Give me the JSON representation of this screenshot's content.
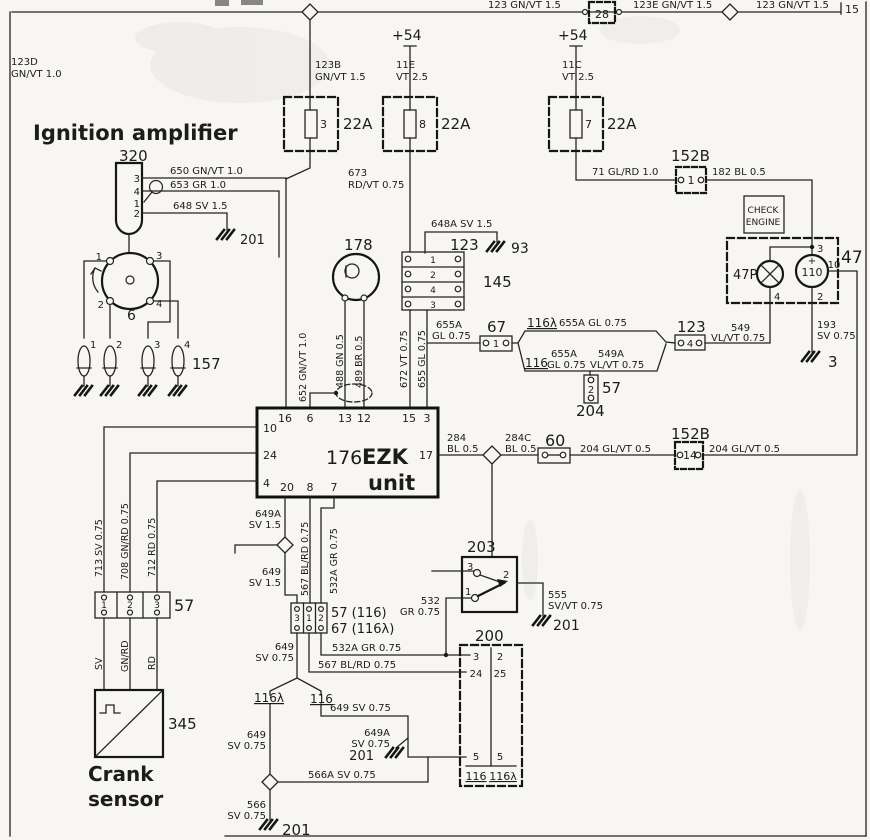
{
  "colors": {
    "ink": "#1c1c1c",
    "annotation_blue": "#5d80b4",
    "paper": "#f7f6f2"
  },
  "labels": [
    {
      "t": "123 GN/VT 1.5",
      "x": 488,
      "y": 8,
      "s": 10,
      "n": "wire-123-gnvt-a"
    },
    {
      "t": "28",
      "x": 602,
      "y": 18,
      "s": 11,
      "a": "middle",
      "n": "connector-28-number"
    },
    {
      "t": "123E GN/VT 1.5",
      "x": 633,
      "y": 8,
      "s": 10,
      "n": "wire-123e-gnvt"
    },
    {
      "t": "123 GN/VT 1.5",
      "x": 756,
      "y": 8,
      "s": 10,
      "n": "wire-123-gnvt-b"
    },
    {
      "t": "15",
      "x": 845,
      "y": 13,
      "s": 11,
      "n": "terminal-15"
    },
    {
      "t": "123D",
      "x": 11,
      "y": 65,
      "s": 10,
      "n": "wire-123d"
    },
    {
      "t": "GN/VT 1.0",
      "x": 11,
      "y": 77,
      "s": 10
    },
    {
      "t": "+54",
      "x": 392,
      "y": 40,
      "s": 14,
      "n": "terminal-54-a"
    },
    {
      "t": "+54",
      "x": 558,
      "y": 40,
      "s": 14,
      "n": "terminal-54-b"
    },
    {
      "t": "123B",
      "x": 315,
      "y": 68,
      "s": 10,
      "n": "wire-123b"
    },
    {
      "t": "GN/VT 1.5",
      "x": 315,
      "y": 80,
      "s": 10
    },
    {
      "t": "11E",
      "x": 396,
      "y": 68,
      "s": 10,
      "n": "wire-11e"
    },
    {
      "t": "VT 2.5",
      "x": 396,
      "y": 80,
      "s": 10
    },
    {
      "t": "11C",
      "x": 562,
      "y": 68,
      "s": 10,
      "n": "wire-11c"
    },
    {
      "t": "VT 2.5",
      "x": 562,
      "y": 80,
      "s": 10
    },
    {
      "t": "3",
      "x": 320,
      "y": 128,
      "s": 11,
      "n": "fuse-3-number"
    },
    {
      "t": "22A",
      "x": 343,
      "y": 129,
      "s": 15,
      "n": "fuse-3-rating"
    },
    {
      "t": "8",
      "x": 419,
      "y": 128,
      "s": 11,
      "n": "fuse-8-number"
    },
    {
      "t": "22A",
      "x": 441,
      "y": 129,
      "s": 15,
      "n": "fuse-8-rating"
    },
    {
      "t": "7",
      "x": 585,
      "y": 128,
      "s": 11,
      "n": "fuse-7-number"
    },
    {
      "t": "22A",
      "x": 607,
      "y": 129,
      "s": 15,
      "n": "fuse-7-rating"
    },
    {
      "t": "Ignition amplifier",
      "x": 33,
      "y": 140,
      "s": 21,
      "w": 1,
      "c": "b",
      "n": "annotation-ignition-amplifier"
    },
    {
      "t": "320",
      "x": 119,
      "y": 161,
      "s": 15,
      "n": "component-320"
    },
    {
      "t": "650 GN/VT 1.0",
      "x": 170,
      "y": 174,
      "s": 10
    },
    {
      "t": "653 GR 1.0",
      "x": 170,
      "y": 188,
      "s": 10
    },
    {
      "t": "648 SV 1.5",
      "x": 173,
      "y": 209,
      "s": 10
    },
    {
      "t": "201",
      "x": 240,
      "y": 244,
      "s": 13,
      "n": "ground-201-a"
    },
    {
      "t": "3",
      "x": 140,
      "y": 182,
      "s": 10,
      "a": "end"
    },
    {
      "t": "4",
      "x": 140,
      "y": 195,
      "s": 10,
      "a": "end"
    },
    {
      "t": "1",
      "x": 140,
      "y": 207,
      "s": 10,
      "a": "end"
    },
    {
      "t": "2",
      "x": 140,
      "y": 217,
      "s": 10,
      "a": "end"
    },
    {
      "t": "673",
      "x": 348,
      "y": 176,
      "s": 10
    },
    {
      "t": "RD/VT 0.75",
      "x": 348,
      "y": 188,
      "s": 10
    },
    {
      "t": "648A SV 1.5",
      "x": 431,
      "y": 227,
      "s": 10
    },
    {
      "t": "123",
      "x": 450,
      "y": 250,
      "s": 15,
      "n": "connector-123-a"
    },
    {
      "t": "93",
      "x": 511,
      "y": 253,
      "s": 14,
      "n": "ground-93"
    },
    {
      "t": "145",
      "x": 483,
      "y": 287,
      "s": 15,
      "n": "connector-145"
    },
    {
      "t": "1",
      "x": 433,
      "y": 263,
      "s": 9,
      "a": "middle"
    },
    {
      "t": "2",
      "x": 433,
      "y": 278,
      "s": 9,
      "a": "middle"
    },
    {
      "t": "4",
      "x": 433,
      "y": 293,
      "s": 9,
      "a": "middle"
    },
    {
      "t": "3",
      "x": 433,
      "y": 308,
      "s": 9,
      "a": "middle"
    },
    {
      "t": "178",
      "x": 344,
      "y": 250,
      "s": 15,
      "n": "component-178"
    },
    {
      "t": "152B",
      "x": 671,
      "y": 161,
      "s": 15,
      "n": "connector-152b-1"
    },
    {
      "t": "1",
      "x": 691,
      "y": 184,
      "s": 11,
      "a": "middle"
    },
    {
      "t": "71 GL/RD 1.0",
      "x": 592,
      "y": 175,
      "s": 10
    },
    {
      "t": "182 BL 0.5",
      "x": 712,
      "y": 175,
      "s": 10
    },
    {
      "t": "CHECK",
      "x": 763,
      "y": 213,
      "s": 9,
      "a": "middle",
      "n": "check-engine-text"
    },
    {
      "t": "ENGINE",
      "x": 763,
      "y": 225,
      "s": 9,
      "a": "middle"
    },
    {
      "t": "47P",
      "x": 733,
      "y": 279,
      "s": 13,
      "n": "lamp-47p"
    },
    {
      "t": "47",
      "x": 841,
      "y": 263,
      "s": 17,
      "n": "component-47"
    },
    {
      "t": "110",
      "x": 812,
      "y": 276,
      "s": 11,
      "a": "middle",
      "n": "gauge-110"
    },
    {
      "t": "+",
      "x": 812,
      "y": 264,
      "s": 10,
      "a": "middle"
    },
    {
      "t": "−",
      "x": 812,
      "y": 290,
      "s": 10,
      "a": "middle"
    },
    {
      "t": "3",
      "x": 817,
      "y": 252,
      "s": 10
    },
    {
      "t": "10",
      "x": 834,
      "y": 268,
      "s": 10,
      "a": "middle"
    },
    {
      "t": "2",
      "x": 817,
      "y": 300,
      "s": 10
    },
    {
      "t": "4",
      "x": 774,
      "y": 300,
      "s": 10
    },
    {
      "t": "193",
      "x": 817,
      "y": 328,
      "s": 10
    },
    {
      "t": "SV 0.75",
      "x": 817,
      "y": 339,
      "s": 10
    },
    {
      "t": "3",
      "x": 828,
      "y": 367,
      "s": 15,
      "n": "ground-3"
    },
    {
      "t": "549",
      "x": 731,
      "y": 331,
      "s": 10
    },
    {
      "t": "VL/VT 0.75",
      "x": 711,
      "y": 341,
      "s": 10
    },
    {
      "t": "123",
      "x": 677,
      "y": 332,
      "s": 15,
      "n": "connector-123-b"
    },
    {
      "t": "4",
      "x": 690,
      "y": 347,
      "s": 10,
      "a": "middle"
    },
    {
      "t": "67",
      "x": 487,
      "y": 332,
      "s": 15,
      "n": "connector-67"
    },
    {
      "t": "1",
      "x": 496,
      "y": 347,
      "s": 10,
      "a": "middle"
    },
    {
      "t": "655A",
      "x": 436,
      "y": 328,
      "s": 10
    },
    {
      "t": "GL 0.75",
      "x": 432,
      "y": 339,
      "s": 10
    },
    {
      "t": "116λ",
      "x": 527,
      "y": 327,
      "s": 12,
      "u": 1,
      "n": "harness-116-lambda"
    },
    {
      "t": "655A GL 0.75",
      "x": 559,
      "y": 326,
      "s": 10
    },
    {
      "t": "116",
      "x": 525,
      "y": 367,
      "s": 12,
      "u": 1,
      "n": "harness-116"
    },
    {
      "t": "655A",
      "x": 551,
      "y": 357,
      "s": 10
    },
    {
      "t": "GL 0.75",
      "x": 547,
      "y": 368,
      "s": 10
    },
    {
      "t": "549A",
      "x": 598,
      "y": 357,
      "s": 10
    },
    {
      "t": "VL/VT 0.75",
      "x": 590,
      "y": 368,
      "s": 10
    },
    {
      "t": "57",
      "x": 602,
      "y": 393,
      "s": 15,
      "n": "connector-57-mid"
    },
    {
      "t": "2",
      "x": 591,
      "y": 393,
      "s": 10,
      "a": "middle"
    },
    {
      "t": "204",
      "x": 576,
      "y": 416,
      "s": 15,
      "n": "connector-204"
    },
    {
      "t": "284",
      "x": 447,
      "y": 441,
      "s": 10
    },
    {
      "t": "BL 0.5",
      "x": 447,
      "y": 452,
      "s": 10
    },
    {
      "t": "284C",
      "x": 505,
      "y": 441,
      "s": 10
    },
    {
      "t": "BL 0.5",
      "x": 505,
      "y": 452,
      "s": 10
    },
    {
      "t": "60",
      "x": 545,
      "y": 446,
      "s": 16,
      "n": "connector-60"
    },
    {
      "t": "204 GL/VT 0.5",
      "x": 580,
      "y": 452,
      "s": 10
    },
    {
      "t": "152B",
      "x": 671,
      "y": 439,
      "s": 15,
      "n": "connector-152b-14"
    },
    {
      "t": "14",
      "x": 690,
      "y": 459,
      "s": 11,
      "a": "middle"
    },
    {
      "t": "204 GL/VT 0.5",
      "x": 709,
      "y": 452,
      "s": 10
    },
    {
      "t": "16",
      "x": 285,
      "y": 422,
      "s": 11,
      "a": "middle",
      "n": "ezk-pin-16"
    },
    {
      "t": "6",
      "x": 310,
      "y": 422,
      "s": 11,
      "a": "middle",
      "n": "ezk-pin-6"
    },
    {
      "t": "13",
      "x": 345,
      "y": 422,
      "s": 11,
      "a": "middle",
      "n": "ezk-pin-13"
    },
    {
      "t": "12",
      "x": 364,
      "y": 422,
      "s": 11,
      "a": "middle",
      "n": "ezk-pin-12"
    },
    {
      "t": "15",
      "x": 409,
      "y": 422,
      "s": 11,
      "a": "middle",
      "n": "ezk-pin-15"
    },
    {
      "t": "3",
      "x": 427,
      "y": 422,
      "s": 11,
      "a": "middle",
      "n": "ezk-pin-3"
    },
    {
      "t": "10",
      "x": 263,
      "y": 432,
      "s": 11,
      "n": "ezk-pin-10"
    },
    {
      "t": "24",
      "x": 263,
      "y": 459,
      "s": 11,
      "n": "ezk-pin-24"
    },
    {
      "t": "4",
      "x": 263,
      "y": 487,
      "s": 11,
      "n": "ezk-pin-4"
    },
    {
      "t": "17",
      "x": 433,
      "y": 459,
      "s": 11,
      "a": "end",
      "n": "ezk-pin-17"
    },
    {
      "t": "20",
      "x": 287,
      "y": 491,
      "s": 11,
      "a": "middle",
      "n": "ezk-pin-20"
    },
    {
      "t": "8",
      "x": 310,
      "y": 491,
      "s": 11,
      "a": "middle",
      "n": "ezk-pin-8"
    },
    {
      "t": "7",
      "x": 334,
      "y": 491,
      "s": 11,
      "a": "middle",
      "n": "ezk-pin-7"
    },
    {
      "t": "176",
      "x": 326,
      "y": 464,
      "s": 19,
      "n": "component-176"
    },
    {
      "t": "EZK",
      "x": 362,
      "y": 464,
      "s": 21,
      "w": 1,
      "c": "b",
      "n": "annotation-ezk"
    },
    {
      "t": "unit",
      "x": 368,
      "y": 490,
      "s": 21,
      "w": 1,
      "c": "b",
      "n": "annotation-unit"
    },
    {
      "t": "652 GN/VT 1.0",
      "x": 306,
      "y": 402,
      "s": 9.5,
      "r": 1
    },
    {
      "t": "488 GN 0.5",
      "x": 343,
      "y": 388,
      "s": 9.5,
      "r": 1
    },
    {
      "t": "489 BR 0.5",
      "x": 362,
      "y": 388,
      "s": 9.5,
      "r": 1
    },
    {
      "t": "672 VT 0.75",
      "x": 407,
      "y": 388,
      "s": 9.5,
      "r": 1
    },
    {
      "t": "655 GL 0.75",
      "x": 425,
      "y": 388,
      "s": 9.5,
      "r": 1
    },
    {
      "t": "713 SV 0.75",
      "x": 102,
      "y": 577,
      "s": 9.5,
      "r": 1
    },
    {
      "t": "708 GN/RD 0.75",
      "x": 128,
      "y": 580,
      "s": 9.5,
      "r": 1
    },
    {
      "t": "712 RD 0.75",
      "x": 155,
      "y": 577,
      "s": 9.5,
      "r": 1
    },
    {
      "t": "SV",
      "x": 102,
      "y": 670,
      "s": 9.5,
      "r": 1
    },
    {
      "t": "GN/RD",
      "x": 128,
      "y": 672,
      "s": 9.5,
      "r": 1
    },
    {
      "t": "RD",
      "x": 155,
      "y": 670,
      "s": 9.5,
      "r": 1
    },
    {
      "t": "567 BL/RD 0.75",
      "x": 308,
      "y": 596,
      "s": 9.5,
      "r": 1
    },
    {
      "t": "532A GR 0.75",
      "x": 337,
      "y": 594,
      "s": 9.5,
      "r": 1
    },
    {
      "t": "1",
      "x": 102,
      "y": 260,
      "s": 10,
      "a": "end"
    },
    {
      "t": "3",
      "x": 156,
      "y": 259,
      "s": 10
    },
    {
      "t": "2",
      "x": 104,
      "y": 308,
      "s": 10,
      "a": "end"
    },
    {
      "t": "4",
      "x": 156,
      "y": 307,
      "s": 10
    },
    {
      "t": "6",
      "x": 127,
      "y": 320,
      "s": 14,
      "n": "component-6-distributor"
    },
    {
      "t": "157",
      "x": 192,
      "y": 369,
      "s": 15,
      "n": "component-157-spark-plugs"
    },
    {
      "t": "1",
      "x": 90,
      "y": 348,
      "s": 10
    },
    {
      "t": "2",
      "x": 116,
      "y": 348,
      "s": 10
    },
    {
      "t": "3",
      "x": 154,
      "y": 348,
      "s": 10
    },
    {
      "t": "4",
      "x": 184,
      "y": 348,
      "s": 10
    },
    {
      "t": "57",
      "x": 174,
      "y": 611,
      "s": 16,
      "n": "connector-57-crank"
    },
    {
      "t": "1",
      "x": 104,
      "y": 608,
      "s": 9,
      "a": "middle"
    },
    {
      "t": "2",
      "x": 130,
      "y": 608,
      "s": 9,
      "a": "middle"
    },
    {
      "t": "3",
      "x": 157,
      "y": 608,
      "s": 9,
      "a": "middle"
    },
    {
      "t": "345",
      "x": 168,
      "y": 729,
      "s": 15,
      "n": "component-345"
    },
    {
      "t": "Crank",
      "x": 88,
      "y": 781,
      "s": 20,
      "w": 1,
      "c": "b",
      "n": "annotation-crank"
    },
    {
      "t": "sensor",
      "x": 88,
      "y": 806,
      "s": 20,
      "w": 1,
      "c": "b",
      "n": "annotation-sensor"
    },
    {
      "t": "649A",
      "x": 281,
      "y": 517,
      "s": 10,
      "a": "end"
    },
    {
      "t": "SV 1.5",
      "x": 281,
      "y": 528,
      "s": 10,
      "a": "end"
    },
    {
      "t": "649",
      "x": 281,
      "y": 575,
      "s": 10,
      "a": "end"
    },
    {
      "t": "SV 1.5",
      "x": 281,
      "y": 586,
      "s": 10,
      "a": "end"
    },
    {
      "t": "3",
      "x": 297,
      "y": 621,
      "s": 9,
      "a": "middle"
    },
    {
      "t": "1",
      "x": 309,
      "y": 621,
      "s": 9,
      "a": "middle"
    },
    {
      "t": "2",
      "x": 321,
      "y": 621,
      "s": 9,
      "a": "middle"
    },
    {
      "t": "57 (116)",
      "x": 331,
      "y": 617,
      "s": 13,
      "n": "connector-57-116"
    },
    {
      "t": "67 (116λ)",
      "x": 331,
      "y": 633,
      "s": 13,
      "n": "connector-67-116"
    },
    {
      "t": "649",
      "x": 294,
      "y": 650,
      "s": 10,
      "a": "end"
    },
    {
      "t": "SV 0.75",
      "x": 294,
      "y": 661,
      "s": 10,
      "a": "end"
    },
    {
      "t": "532A GR 0.75",
      "x": 332,
      "y": 651,
      "s": 10
    },
    {
      "t": "567 BL/RD 0.75",
      "x": 318,
      "y": 668,
      "s": 10
    },
    {
      "t": "116λ",
      "x": 254,
      "y": 702,
      "s": 12,
      "u": 1
    },
    {
      "t": "116",
      "x": 310,
      "y": 703,
      "s": 12,
      "u": 1
    },
    {
      "t": "649",
      "x": 266,
      "y": 738,
      "s": 10,
      "a": "end"
    },
    {
      "t": "SV 0.75",
      "x": 266,
      "y": 749,
      "s": 10,
      "a": "end"
    },
    {
      "t": "649 SV 0.75",
      "x": 330,
      "y": 711,
      "s": 10
    },
    {
      "t": "649A",
      "x": 390,
      "y": 736,
      "s": 10,
      "a": "end"
    },
    {
      "t": "SV 0.75",
      "x": 390,
      "y": 747,
      "s": 10,
      "a": "end"
    },
    {
      "t": "201",
      "x": 374,
      "y": 760,
      "s": 13,
      "a": "end",
      "n": "ground-201-mid"
    },
    {
      "t": "566A SV 0.75",
      "x": 308,
      "y": 778,
      "s": 10
    },
    {
      "t": "566",
      "x": 266,
      "y": 808,
      "s": 10,
      "a": "end"
    },
    {
      "t": "SV 0.75",
      "x": 266,
      "y": 819,
      "s": 10,
      "a": "end"
    },
    {
      "t": "201",
      "x": 282,
      "y": 835,
      "s": 15,
      "n": "ground-201-bottom"
    },
    {
      "t": "203",
      "x": 467,
      "y": 552,
      "s": 15,
      "n": "component-203"
    },
    {
      "t": "3",
      "x": 467,
      "y": 570,
      "s": 10
    },
    {
      "t": "1",
      "x": 465,
      "y": 595,
      "s": 10
    },
    {
      "t": "2",
      "x": 503,
      "y": 578,
      "s": 10
    },
    {
      "t": "532",
      "x": 440,
      "y": 604,
      "s": 10,
      "a": "end"
    },
    {
      "t": "GR 0.75",
      "x": 440,
      "y": 615,
      "s": 10,
      "a": "end"
    },
    {
      "t": "555",
      "x": 548,
      "y": 598,
      "s": 10
    },
    {
      "t": "SV/VT 0.75",
      "x": 548,
      "y": 609,
      "s": 10
    },
    {
      "t": "201",
      "x": 553,
      "y": 630,
      "s": 14,
      "n": "ground-201-switch"
    },
    {
      "t": "200",
      "x": 475,
      "y": 641,
      "s": 15,
      "n": "component-200"
    },
    {
      "t": "3",
      "x": 476,
      "y": 660,
      "s": 10,
      "a": "middle"
    },
    {
      "t": "2",
      "x": 500,
      "y": 660,
      "s": 10,
      "a": "middle"
    },
    {
      "t": "24",
      "x": 476,
      "y": 677,
      "s": 10,
      "a": "middle"
    },
    {
      "t": "25",
      "x": 500,
      "y": 677,
      "s": 10,
      "a": "middle"
    },
    {
      "t": "5",
      "x": 476,
      "y": 760,
      "s": 10,
      "a": "middle"
    },
    {
      "t": "5",
      "x": 500,
      "y": 760,
      "s": 10,
      "a": "middle"
    },
    {
      "t": "116",
      "x": 476,
      "y": 780,
      "s": 11,
      "a": "middle",
      "u": 1
    },
    {
      "t": "116λ",
      "x": 503,
      "y": 780,
      "s": 11,
      "a": "middle",
      "u": 1
    }
  ]
}
